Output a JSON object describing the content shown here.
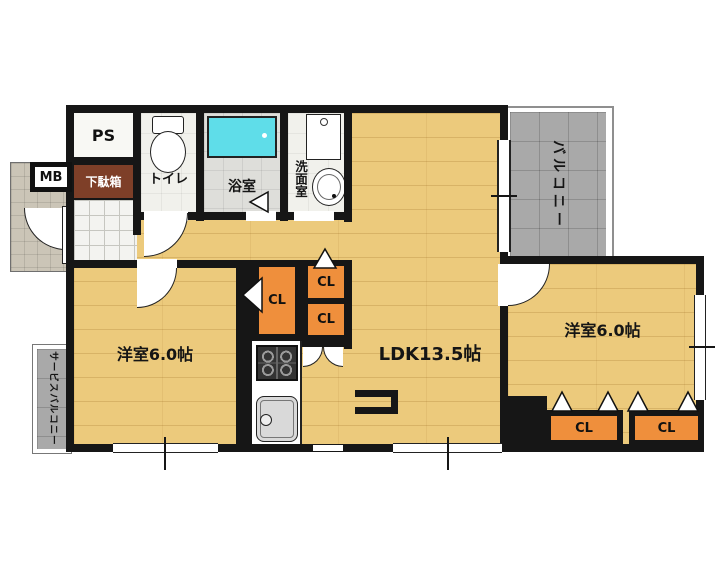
{
  "plan": {
    "rooms": {
      "ps": {
        "label": "PS"
      },
      "meter_box": {
        "label": "MB"
      },
      "shoe_cabinet": {
        "label": "下駄箱"
      },
      "toilet": {
        "label": "トイレ"
      },
      "bathroom": {
        "label": "浴室"
      },
      "washroom": {
        "label": "洗面室"
      },
      "balcony": {
        "label": "バルコニー"
      },
      "service_balcony": {
        "label": "サービスバルコニー"
      },
      "west_room": {
        "label": "洋室6.0帖"
      },
      "ldk": {
        "label": "LDK13.5帖"
      },
      "east_room": {
        "label": "洋室6.0帖"
      }
    },
    "closets": [
      {
        "label": "CL"
      },
      {
        "label": "CL"
      },
      {
        "label": "CL"
      },
      {
        "label": "CL"
      },
      {
        "label": "CL"
      }
    ],
    "colors": {
      "wall": "#161616",
      "wood_floor": "#ecca7c",
      "closet": "#ef8f3c",
      "balcony": "#a9a9a9",
      "bathtub": "#5fdde9",
      "shoe_cabinet": "#7e3f28"
    }
  }
}
